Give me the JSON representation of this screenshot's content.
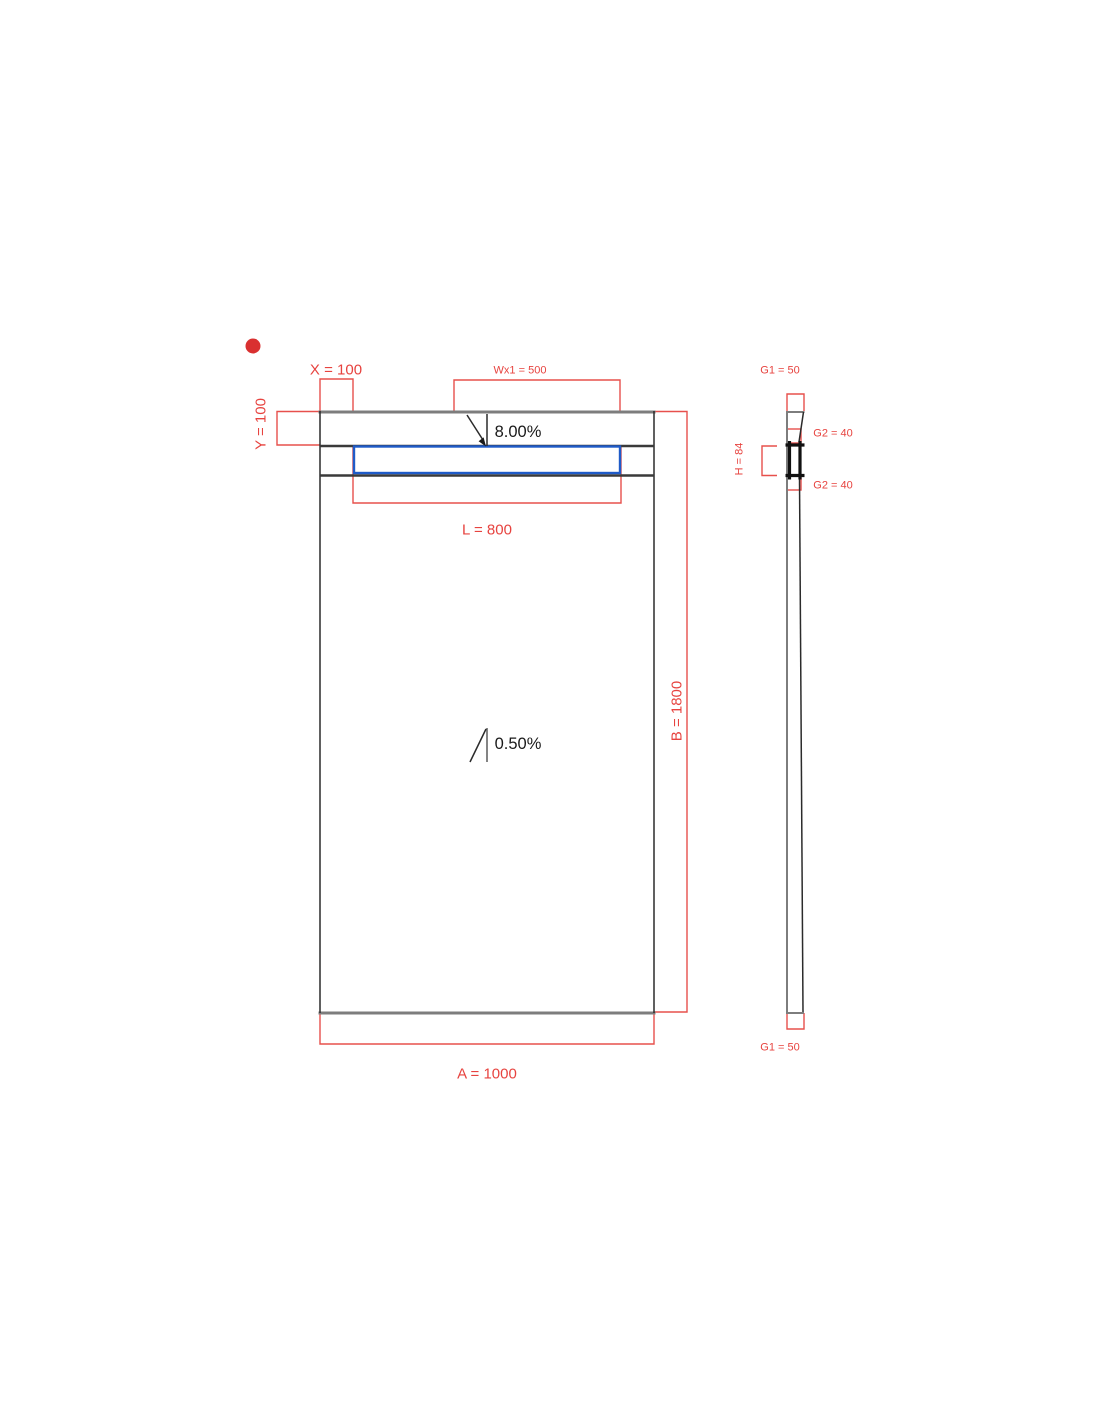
{
  "drawing": {
    "type": "shower-tray technical drawing, plan view with side section",
    "plan_view": {
      "dim_x_label": "X = 100",
      "dim_wx1_label": "Wx1 = 500",
      "dim_y_label": "Y = 100",
      "slope_top_label": "8.00%",
      "dim_l_label": "L = 800",
      "dim_b_label": "B = 1800",
      "slope_main_label": "0.50%",
      "dim_a_label": "A = 1000"
    },
    "side_view": {
      "dim_g1_top_label": "G1 = 50",
      "dim_g2_upper_label": "G2 = 40",
      "dim_h_label": "H = 84",
      "dim_g2_lower_label": "G2 = 40",
      "dim_g1_bottom_label": "G1 = 50"
    },
    "colors": {
      "dimension_red": "#e7504c",
      "outline_black": "#2b2b2b",
      "edge_gray": "#7d7d7d",
      "channel_blue": "#1f5bc8",
      "marker_dot_red": "#d93030",
      "slope_text_black": "#1a1a1a",
      "background": "#ffffff"
    }
  }
}
